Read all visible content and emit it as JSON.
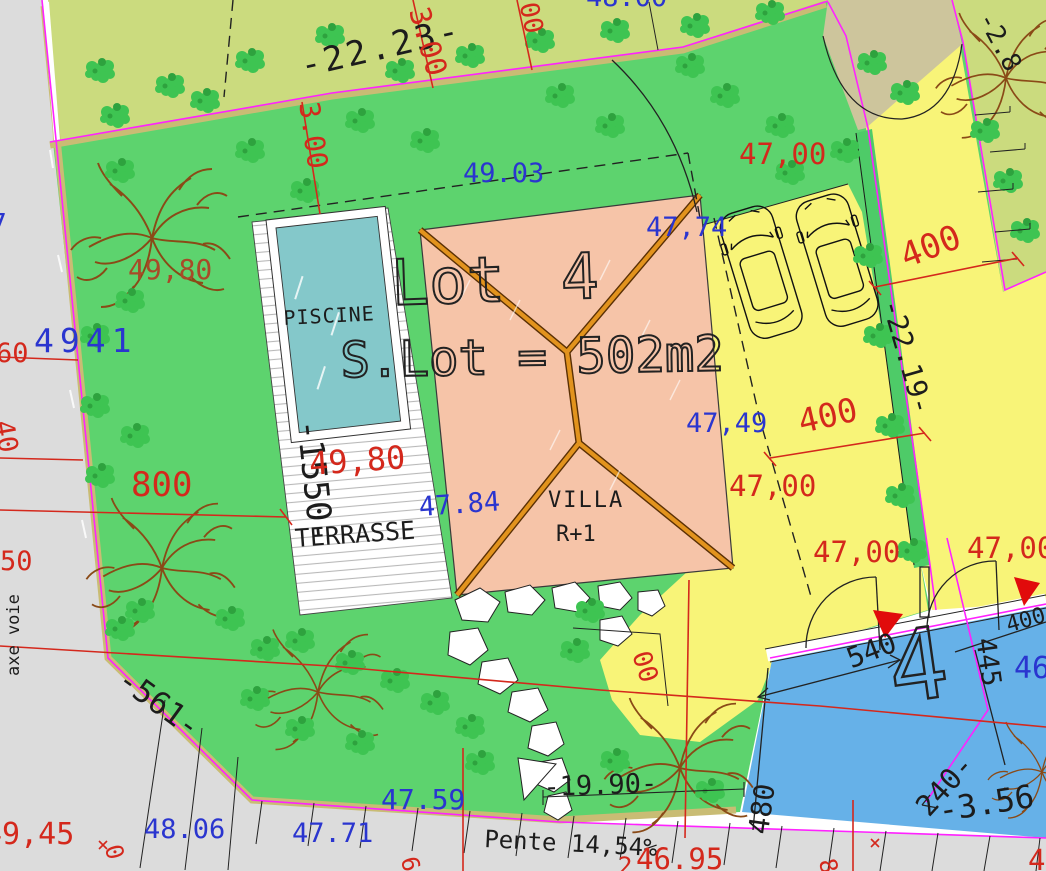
{
  "plan_type": "site-plan",
  "labels": {
    "dim_top_2223": "-22.23-",
    "dim_300_top": "3.00",
    "dim_300_top_partial": "00",
    "dim_300_left": "3.00",
    "level_48_00_partial": "48.00",
    "level_49_03": "49.03",
    "level_7_partial": "7",
    "level_49_80_garden": "49,80",
    "level_49_41": "4941",
    "dim_1550": "-1550-",
    "dim_800": "800",
    "road_dim_60": "60",
    "road_dim_40": "40",
    "road_dim_50": "50",
    "axe_voie": "axe voie",
    "dim_561": "-561-",
    "level_49_45": "49,45",
    "level_48_06": "48.06",
    "level_47_71": "47.71",
    "level_47_59": "47.59",
    "dim_1990": "-19.90-",
    "pente": "Pente 14,54%",
    "level_46_95": "46.95",
    "level_4_partial": "4",
    "lot_title": "Lot 4",
    "lot_area": "S.Lot = 502m2",
    "piscine": "PISCINE",
    "terrasse": "TERRASSE",
    "level_49_80_terrace": "49,80",
    "level_47_84": "47.84",
    "villa": "VILLA",
    "villa_floor": "R+1",
    "level_47_00_top": "47,00",
    "level_47_74": "47,74",
    "dim_400_ne": "400",
    "dim_2219": "-22.19-",
    "dim_400_mid": "400",
    "level_47_49": "47,49",
    "level_47_00_mid": "47,00",
    "level_47_00_low": "47,00",
    "level_47_00_right": "47,00",
    "dim_2_8_partial": "-2.8",
    "dim_00_partial": "00",
    "parcel_number": "4",
    "dim_540": "540",
    "dim_480": "480",
    "dim_240": "240-",
    "dim_445": "445",
    "dim_400_blue": "400",
    "dim_356": "-3.56",
    "level_46_partial": "46",
    "frag_0": "0",
    "frag_6": "6",
    "frag_2": "2",
    "frag_8": "8"
  },
  "colors": {
    "lawn_green": "#5dd36e",
    "neighbor_lot_green": "#cbdb7e",
    "driveway_yellow": "#f8f478",
    "blue_zone": "#66b1e8",
    "pool_teal": "#84c8ca",
    "roof_salmon": "#f6c4a8",
    "roof_ridge_orange": "#e2931d",
    "boundary_magenta": "#ff22ff",
    "dimension_red": "#d4281c",
    "level_blue": "#2a35cf",
    "road_grey": "#dcdcdc",
    "hedge_khaki": "#c9bc74",
    "tree_brown": "#8a4a17"
  }
}
